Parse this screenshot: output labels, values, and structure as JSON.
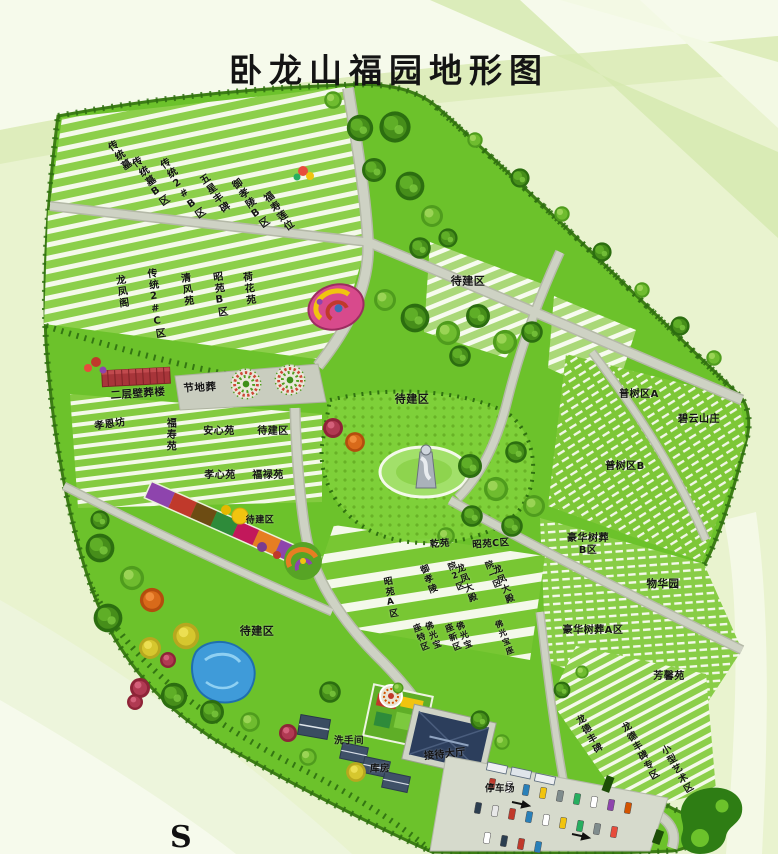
{
  "title": "卧龙山福园地形图",
  "compass": {
    "south": "S"
  },
  "palette": {
    "bg": "#e9f3cf",
    "band-light": "#f6faeb",
    "band-mid": "#d5e9ae",
    "map-green": "#6cc22b",
    "map-border": "#3c7d15",
    "tree-line": "#2e6e10",
    "stripe": "#f4f9ea",
    "road": "#ced2c4",
    "road-edge": "#b4b9a7",
    "plaza": "#c9cdbf",
    "pond": "#3f9bd9",
    "red-building": "#a8353a",
    "hall-roof": "#2c3e5c",
    "parking": "#d6dacc",
    "label-ink": "#141414"
  },
  "map": {
    "labels": [
      {
        "text": "传统墓",
        "x": 118,
        "y": 157,
        "m": "v",
        "r": -35,
        "s": 10
      },
      {
        "text": "传统墓B区",
        "x": 149,
        "y": 183,
        "m": "v",
        "r": -35,
        "s": 10
      },
      {
        "text": "传统2#B区",
        "x": 181,
        "y": 190,
        "m": "v",
        "r": -35,
        "s": 10
      },
      {
        "text": "五星丰碑",
        "x": 213,
        "y": 195,
        "m": "v",
        "r": -35,
        "s": 10
      },
      {
        "text": "御孝陵B区",
        "x": 249,
        "y": 205,
        "m": "v",
        "r": -35,
        "s": 10
      },
      {
        "text": "福寿莲位",
        "x": 277,
        "y": 213,
        "m": "v",
        "r": -35,
        "s": 10
      },
      {
        "text": "龙凤阁",
        "x": 120,
        "y": 292,
        "m": "v",
        "r": -8,
        "s": 10
      },
      {
        "text": "传统2#C区",
        "x": 154,
        "y": 304,
        "m": "v",
        "r": -8,
        "s": 10
      },
      {
        "text": "清风苑",
        "x": 185,
        "y": 290,
        "m": "v",
        "r": -8,
        "s": 10
      },
      {
        "text": "昭苑B区",
        "x": 218,
        "y": 295,
        "m": "v",
        "r": -8,
        "s": 10
      },
      {
        "text": "荷花苑",
        "x": 247,
        "y": 289,
        "m": "v",
        "r": -8,
        "s": 10
      },
      {
        "text": "待建区",
        "x": 468,
        "y": 282,
        "m": "h",
        "r": 0,
        "s": 11
      },
      {
        "text": "节地葬",
        "x": 200,
        "y": 388,
        "m": "h",
        "r": -3,
        "s": 10.5
      },
      {
        "text": "二层壁葬楼",
        "x": 138,
        "y": 394,
        "m": "h",
        "r": -4,
        "s": 10.5
      },
      {
        "text": "孝恩坊",
        "x": 110,
        "y": 425,
        "m": "h",
        "r": -8,
        "s": 10
      },
      {
        "text": "福寿苑",
        "x": 169,
        "y": 435,
        "m": "v",
        "r": 0,
        "s": 10
      },
      {
        "text": "安心苑",
        "x": 219,
        "y": 432,
        "m": "h",
        "r": 0,
        "s": 10
      },
      {
        "text": "待建区",
        "x": 273,
        "y": 432,
        "m": "h",
        "r": 0,
        "s": 10
      },
      {
        "text": "孝心苑",
        "x": 220,
        "y": 476,
        "m": "h",
        "r": 0,
        "s": 10
      },
      {
        "text": "福禄苑",
        "x": 268,
        "y": 476,
        "m": "h",
        "r": 0,
        "s": 10
      },
      {
        "text": "待建区",
        "x": 412,
        "y": 400,
        "m": "h",
        "r": 0,
        "s": 11
      },
      {
        "text": "待建区",
        "x": 260,
        "y": 521,
        "m": "h",
        "r": 0,
        "s": 9
      },
      {
        "text": "待建区",
        "x": 257,
        "y": 632,
        "m": "h",
        "r": 0,
        "s": 11
      },
      {
        "text": "普树区A",
        "x": 639,
        "y": 395,
        "m": "h",
        "r": 0,
        "s": 10
      },
      {
        "text": "碧云山庄",
        "x": 699,
        "y": 420,
        "m": "h",
        "r": 0,
        "s": 10
      },
      {
        "text": "普树区B",
        "x": 625,
        "y": 467,
        "m": "h",
        "r": 0,
        "s": 10
      },
      {
        "text": "豪华树葬\nB区",
        "x": 588,
        "y": 545,
        "m": "h",
        "r": 0,
        "s": 10
      },
      {
        "text": "物华园",
        "x": 663,
        "y": 584,
        "m": "h",
        "r": 0,
        "s": 10.5
      },
      {
        "text": "豪华树葬A区",
        "x": 593,
        "y": 631,
        "m": "h",
        "r": 0,
        "s": 10
      },
      {
        "text": "芳馨苑",
        "x": 669,
        "y": 677,
        "m": "h",
        "r": 0,
        "s": 10
      },
      {
        "text": "乾苑",
        "x": 440,
        "y": 544,
        "m": "h",
        "r": -4,
        "s": 9.5
      },
      {
        "text": "昭苑C区",
        "x": 491,
        "y": 544,
        "m": "h",
        "r": -4,
        "s": 9.5
      },
      {
        "text": "昭苑A区",
        "x": 389,
        "y": 598,
        "m": "v",
        "r": -10,
        "s": 9
      },
      {
        "text": "御孝陵",
        "x": 427,
        "y": 580,
        "m": "v",
        "r": -22,
        "s": 9
      },
      {
        "text": "院2区",
        "x": 455,
        "y": 577,
        "m": "v",
        "r": -22,
        "s": 8.5
      },
      {
        "text": "龙凤大殿",
        "x": 465,
        "y": 584,
        "m": "v",
        "r": -22,
        "s": 9
      },
      {
        "text": "院一区",
        "x": 492,
        "y": 575,
        "m": "v",
        "r": -22,
        "s": 8.5
      },
      {
        "text": "龙凤大殿",
        "x": 502,
        "y": 585,
        "m": "v",
        "r": -22,
        "s": 9
      },
      {
        "text": "座特区",
        "x": 420,
        "y": 638,
        "m": "v",
        "r": -22,
        "s": 8.5
      },
      {
        "text": "佛光宝",
        "x": 432,
        "y": 636,
        "m": "v",
        "r": -22,
        "s": 8.5
      },
      {
        "text": "座新区",
        "x": 452,
        "y": 638,
        "m": "v",
        "r": -22,
        "s": 8.5
      },
      {
        "text": "佛光宝",
        "x": 463,
        "y": 636,
        "m": "v",
        "r": -22,
        "s": 8.5
      },
      {
        "text": "佛光宝座",
        "x": 504,
        "y": 638,
        "m": "v",
        "r": -22,
        "s": 8
      },
      {
        "text": "龙德丰碑",
        "x": 588,
        "y": 735,
        "m": "v",
        "r": -30,
        "s": 9.5
      },
      {
        "text": "龙德丰碑专区",
        "x": 639,
        "y": 752,
        "m": "v",
        "r": -30,
        "s": 9.5
      },
      {
        "text": "小型艺术区",
        "x": 676,
        "y": 770,
        "m": "v",
        "r": -30,
        "s": 9.5
      },
      {
        "text": "洗手间",
        "x": 349,
        "y": 741,
        "m": "h",
        "r": 0,
        "s": 9.5,
        "n": "restroom-label"
      },
      {
        "text": "库房",
        "x": 380,
        "y": 769,
        "m": "h",
        "r": 0,
        "s": 9.5,
        "n": "warehouse-label"
      },
      {
        "text": "接待大厅",
        "x": 445,
        "y": 755,
        "m": "h",
        "r": -6,
        "s": 10,
        "n": "reception-hall-label"
      },
      {
        "text": "停车场",
        "x": 500,
        "y": 789,
        "m": "h",
        "r": 0,
        "s": 9.5,
        "n": "parking-label"
      }
    ]
  }
}
